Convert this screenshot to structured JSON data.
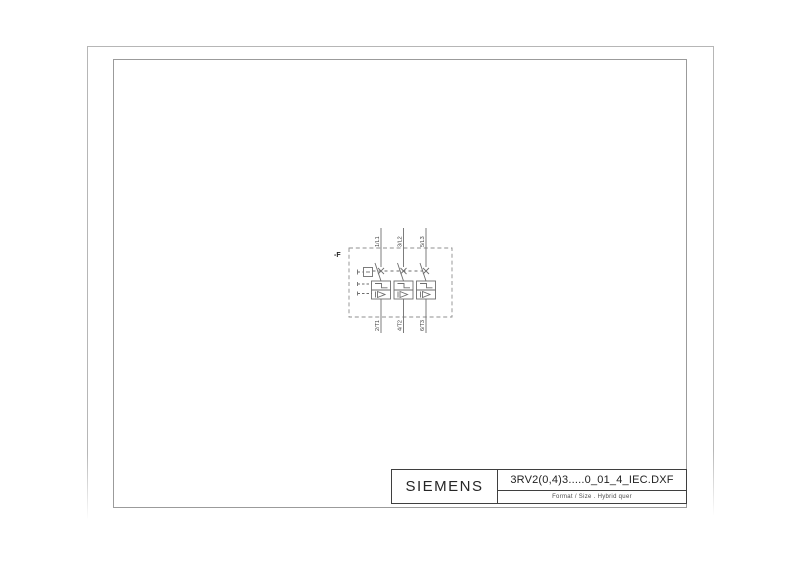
{
  "title_block": {
    "brand": "SIEMENS",
    "filename": "3RV2(0,4)3.....0_01_4_IEC.DXF",
    "format_line": "Format / Size . Hybrid quer"
  },
  "diagram": {
    "device_label": "-F",
    "top_terminals": [
      "1/L1",
      "3/L2",
      "5/L3"
    ],
    "bottom_terminals": [
      "2/T1",
      "4/T2",
      "6/T3"
    ]
  },
  "colors": {
    "outer_frame": "#b6b6b6",
    "inner_frame": "#9b9b9b",
    "title_block_border": "#3f3f3f",
    "circuit_stroke": "#6e6e6e",
    "dashed_boundary": "#8f8f8f",
    "label_text": "#3d3d3d"
  }
}
